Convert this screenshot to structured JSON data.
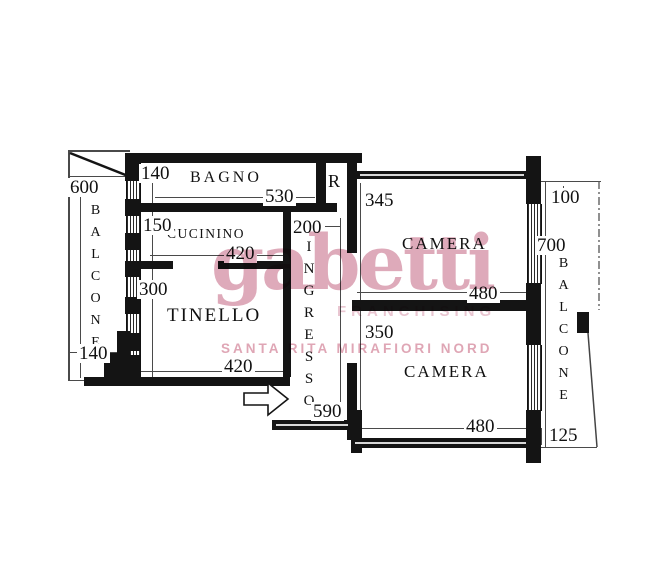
{
  "watermark": {
    "brand": "gabetti",
    "subtitle": "FRANCHISING",
    "agency": "SANTA RITA MIRAFIORI NORD",
    "color": "#d99cae"
  },
  "rooms": {
    "bagno": "BAGNO",
    "cucinino": "CUCININO",
    "tinello": "TINELLO",
    "ingresso": "INGRESSO",
    "ripostiglio": "R",
    "camera_top": "CAMERA",
    "camera_bottom": "CAMERA",
    "balcone_left": "BALCONE",
    "balcone_right": "BALCONE"
  },
  "dims": {
    "balcone_left_len": "600",
    "bagno_offset": "140",
    "bagno_w": "530",
    "cucinino_h": "150",
    "cucinino_w": "420",
    "tinello_h": "300",
    "tinello_w": "420",
    "balcone_left_w": "140",
    "ingresso_w": "200",
    "ingresso_len": "590",
    "camera_top_h": "345",
    "camera_top_w": "480",
    "camera_bottom_h": "350",
    "camera_bottom_w": "480",
    "balcone_right_top": "100",
    "balcone_right_len": "700",
    "balcone_right_bot": "125"
  },
  "colors": {
    "wall": "#141414",
    "line": "#4a4a4a"
  }
}
